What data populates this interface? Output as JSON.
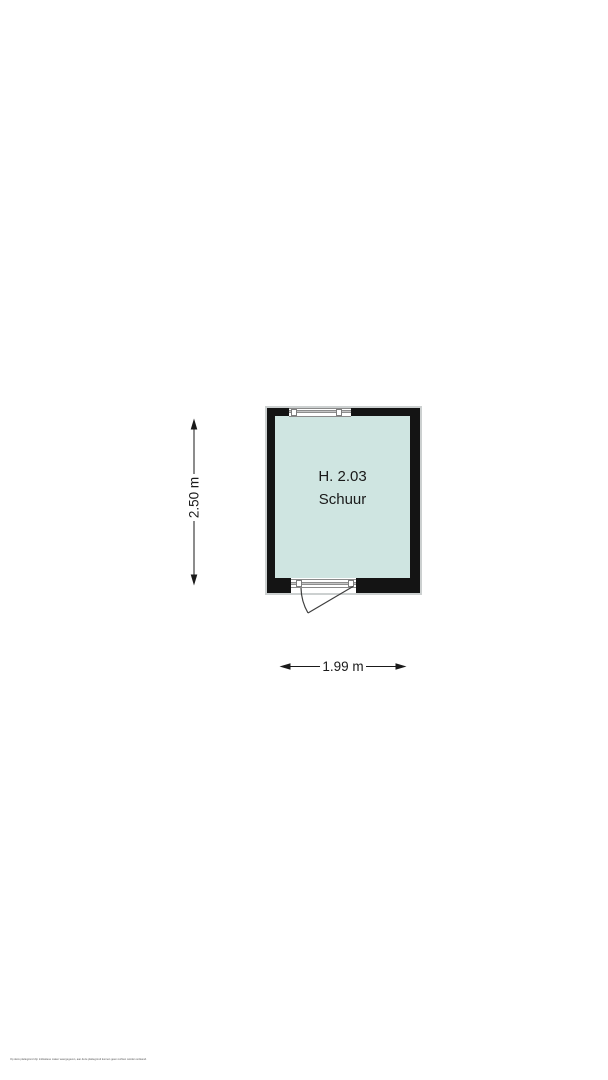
{
  "floorplan": {
    "room": {
      "id_label": "H. 2.03",
      "name_label": "Schuur"
    },
    "dimensions": {
      "height_label": "2.50 m",
      "width_label": "1.99 m"
    },
    "features": {
      "window_top": "window-symbol",
      "door_bottom": "door-with-swing-arc"
    },
    "disclaimer": "Op deze plattegrond zijn indicatieve maten weergegeven, aan deze plattegrond kunnen geen rechten worden ontleend.",
    "colors": {
      "wall": "#141414",
      "floor_fill": "#cfe5e1",
      "building_outline": "#ccd0d0",
      "line": "#3f3f3f",
      "text": "#1a1a1a",
      "band_stripe": "#c4c4c4",
      "background": "#ffffff"
    }
  }
}
